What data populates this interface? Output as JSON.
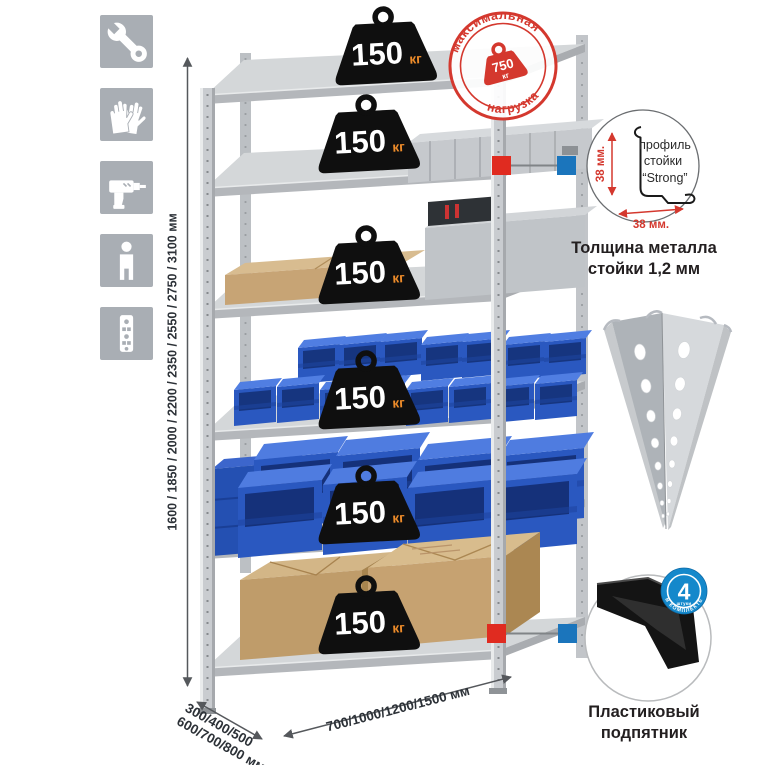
{
  "page": {
    "background": "#ffffff"
  },
  "assembly_icons": {
    "items": [
      {
        "icon": "wrench-icon"
      },
      {
        "icon": "gloves-icon"
      },
      {
        "icon": "drill-icon"
      },
      {
        "icon": "person-icon"
      },
      {
        "icon": "rack-post-icon"
      }
    ]
  },
  "rack": {
    "shelf_count": 6,
    "shelf_loads": [
      {
        "value": "150",
        "unit": "кг"
      },
      {
        "value": "150",
        "unit": "кг"
      },
      {
        "value": "150",
        "unit": "кг"
      },
      {
        "value": "150",
        "unit": "кг"
      },
      {
        "value": "150",
        "unit": "кг"
      },
      {
        "value": "150",
        "unit": "кг"
      }
    ]
  },
  "max_load_stamp": {
    "arc_top": "максимальная",
    "arc_bottom": "нагрузка",
    "value": "750",
    "unit": "кг"
  },
  "dimensions": {
    "height": "1600 / 1850 / 2000 / 2200 / 2350 / 2550 / 2750 / 3100 мм",
    "depth_line1": "300/400/500",
    "depth_line2": "600/700/800 мм",
    "width": "700/1000/1200/1500 мм"
  },
  "profile_detail": {
    "label_line1": "профиль",
    "label_line2": "стойки",
    "label_line3": "“Strong”",
    "dim_vertical": "38 мм.",
    "dim_horizontal": "38 мм.",
    "caption_line1": "Толщина металла",
    "caption_line2": "стойки 1,2 мм"
  },
  "foot_detail": {
    "badge_number": "4",
    "badge_word": "штуки",
    "badge_arc": "В КОМПЛЕКТЕ",
    "caption_line1": "Пластиковый",
    "caption_line2": "подпятник"
  },
  "colors": {
    "stamp_red": "#d4382e",
    "callout_red": "#e02b20",
    "callout_blue": "#1b75bc",
    "badge_blue": "#1488cb",
    "bin_blue": "#2a58c0",
    "weight_black": "#0f0f0f",
    "kg_orange": "#ee8c2a",
    "icon_tile_grey": "#a9aeb4"
  }
}
